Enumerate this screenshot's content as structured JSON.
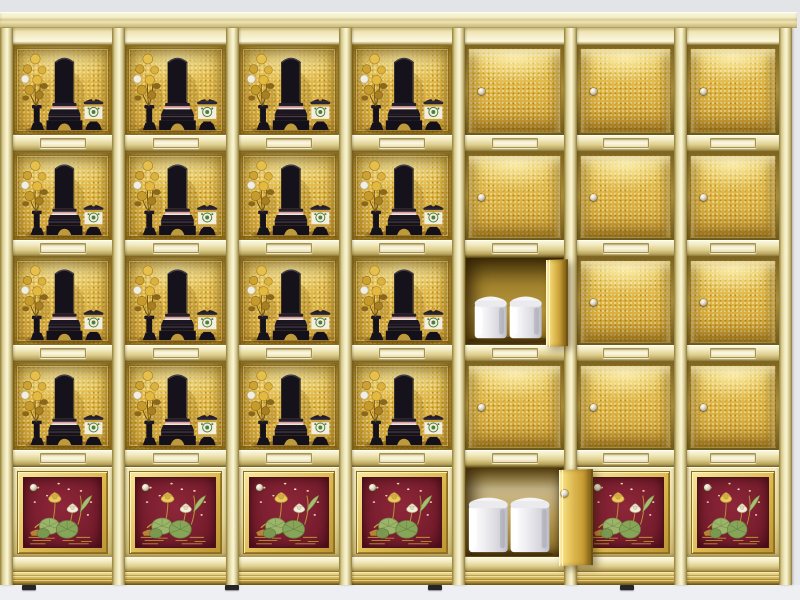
{
  "scene": {
    "subject": "golden columbarium cabinet with memorial altar niches, gold doors and urn compartments",
    "background_top": "#e2e4e8",
    "background_floor": "#edeff2",
    "no_visible_text": true
  },
  "palette": {
    "frame_pale_gold": "#f4eec8",
    "frame_shadow": "#8d7a38",
    "niche_gold": "#e2ba45",
    "niche_gold_dark": "#c99c30",
    "open_interior_bronze": "#8a6b20",
    "red_panel": "#7c1f30",
    "red_panel_dark": "#5e1322",
    "urn_white": "#f2f2f5",
    "tablet_black": "#16121c",
    "flower_gold": "#d9ae38",
    "leaf_green": "#8fa85c",
    "knob_metal": "#ddd6c4",
    "cornice_cream": "#f4eec8",
    "foot_dark": "#26262a"
  },
  "layout": {
    "cabinet": {
      "left": 0,
      "top": 28,
      "width": 792,
      "height": 557
    },
    "cornice": {
      "left": 0,
      "top": 12,
      "width": 797,
      "height": 16
    },
    "posts_x": [
      0,
      112,
      226,
      339,
      452,
      564,
      674,
      779
    ],
    "post_width": 13,
    "top_rail_height": 17,
    "rows": [
      {
        "y": 17,
        "h": 90
      },
      {
        "y": 124,
        "h": 88
      },
      {
        "y": 229,
        "h": 88
      },
      {
        "y": 334,
        "h": 88
      },
      {
        "y": 439,
        "h": 90
      }
    ],
    "shelf_y": [
      107,
      212,
      317,
      422
    ],
    "shelf_height": 17,
    "base_rail": {
      "y": 529,
      "h": 15
    },
    "plinth": {
      "y": 544,
      "h": 13
    },
    "feet_x": [
      22,
      225,
      428,
      620
    ],
    "foot": {
      "y": 585,
      "w": 14,
      "h": 5
    }
  },
  "grid": {
    "columns": [
      {
        "id": "c1",
        "cells": [
          "altar",
          "altar",
          "altar",
          "altar",
          "lotus"
        ]
      },
      {
        "id": "c2",
        "cells": [
          "altar",
          "altar",
          "altar",
          "altar",
          "lotus"
        ]
      },
      {
        "id": "c3",
        "cells": [
          "altar",
          "altar",
          "altar",
          "altar",
          "lotus"
        ]
      },
      {
        "id": "c4",
        "cells": [
          "altar",
          "altar",
          "altar",
          "altar",
          "lotus"
        ]
      },
      {
        "id": "c5",
        "cells": [
          "door",
          "door",
          "open",
          "door",
          "open-large"
        ]
      },
      {
        "id": "c6",
        "cells": [
          "door",
          "door",
          "door",
          "door",
          "lotus"
        ]
      },
      {
        "id": "c7",
        "cells": [
          "door",
          "door",
          "door",
          "door",
          "lotus"
        ]
      }
    ]
  },
  "cell_contents": {
    "altar": {
      "items": [
        "golden-flower-arrangement",
        "black-memorial-tablet-on-pedestal",
        "white-offering-cup-with-lid"
      ]
    },
    "door": {
      "state": "closed",
      "knob": "round-metal-knob",
      "knob_side": "left-center"
    },
    "open": {
      "state": "open",
      "door_swing": "right",
      "urns": 2,
      "urn_style": "white-cylindrical-with-lid"
    },
    "open-large": {
      "state": "open",
      "door_swing": "right",
      "urns": 2,
      "urn_style": "large-white-cylindrical-with-lid"
    },
    "lotus": {
      "art": "lotus-flower-painting",
      "flowers": [
        "yellow-lotus",
        "white-lotus"
      ],
      "knob_position": "top-left"
    }
  },
  "counts": {
    "columns": 7,
    "rows": 5,
    "altar_niches": 16,
    "closed_doors": 11,
    "open_compartments": 2,
    "lotus_panels": 6,
    "nameplate_slots": 28,
    "urns_visible": 4
  }
}
